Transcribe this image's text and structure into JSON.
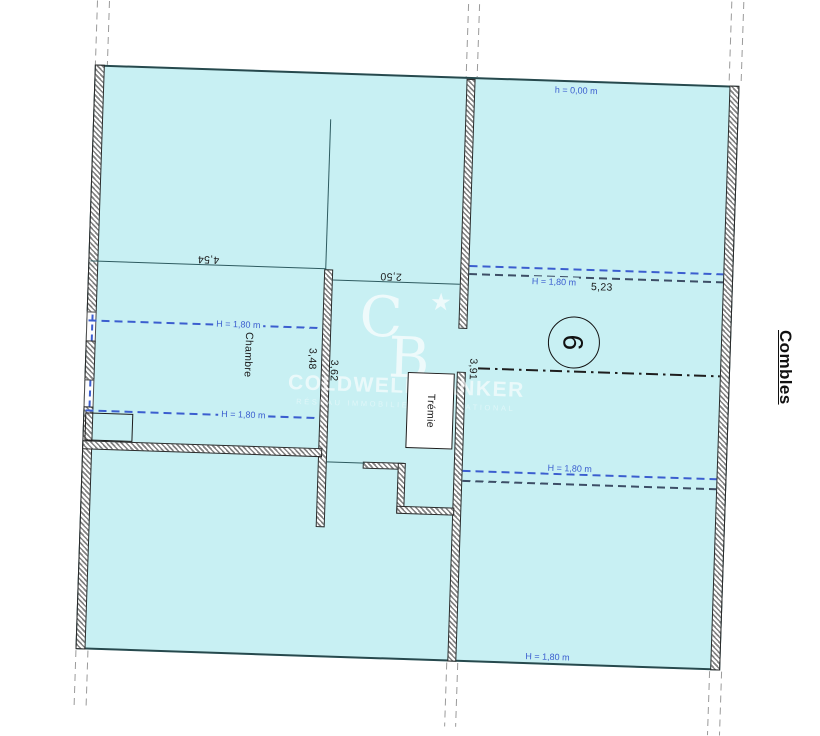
{
  "colors": {
    "room_fill": "#c8f0f3",
    "accent_blue": "#3b5ecf",
    "wall_border": "#2b2b2b",
    "line_teal": "#2e5b60"
  },
  "plan": {
    "floor_label": "Combles",
    "top_height_label": "h = 0,00 m",
    "room": {
      "name": "Chambre",
      "number": "9"
    },
    "tremie_label": "Trémie",
    "dims": {
      "top_left_width": "4,54",
      "mid_width": "2,50",
      "left_height": "3,48",
      "mid_height": "3,62",
      "right_height": "3,91",
      "right_width": "5,23"
    }
  },
  "height_lines": {
    "chambre_upper": "H = 1,80 m",
    "chambre_lower": "H = 1,80 m",
    "right_upper": "H = 1,80 m",
    "right_lower": "H = 1,80 m",
    "bottom": "H = 1,80 m"
  },
  "watermark": {
    "monogram_c": "C",
    "monogram_b": "B",
    "star": "★",
    "name": "COLDWELL BANKER",
    "subtitle": "RÉSEAU IMMOBILIER INTERNATIONAL"
  }
}
